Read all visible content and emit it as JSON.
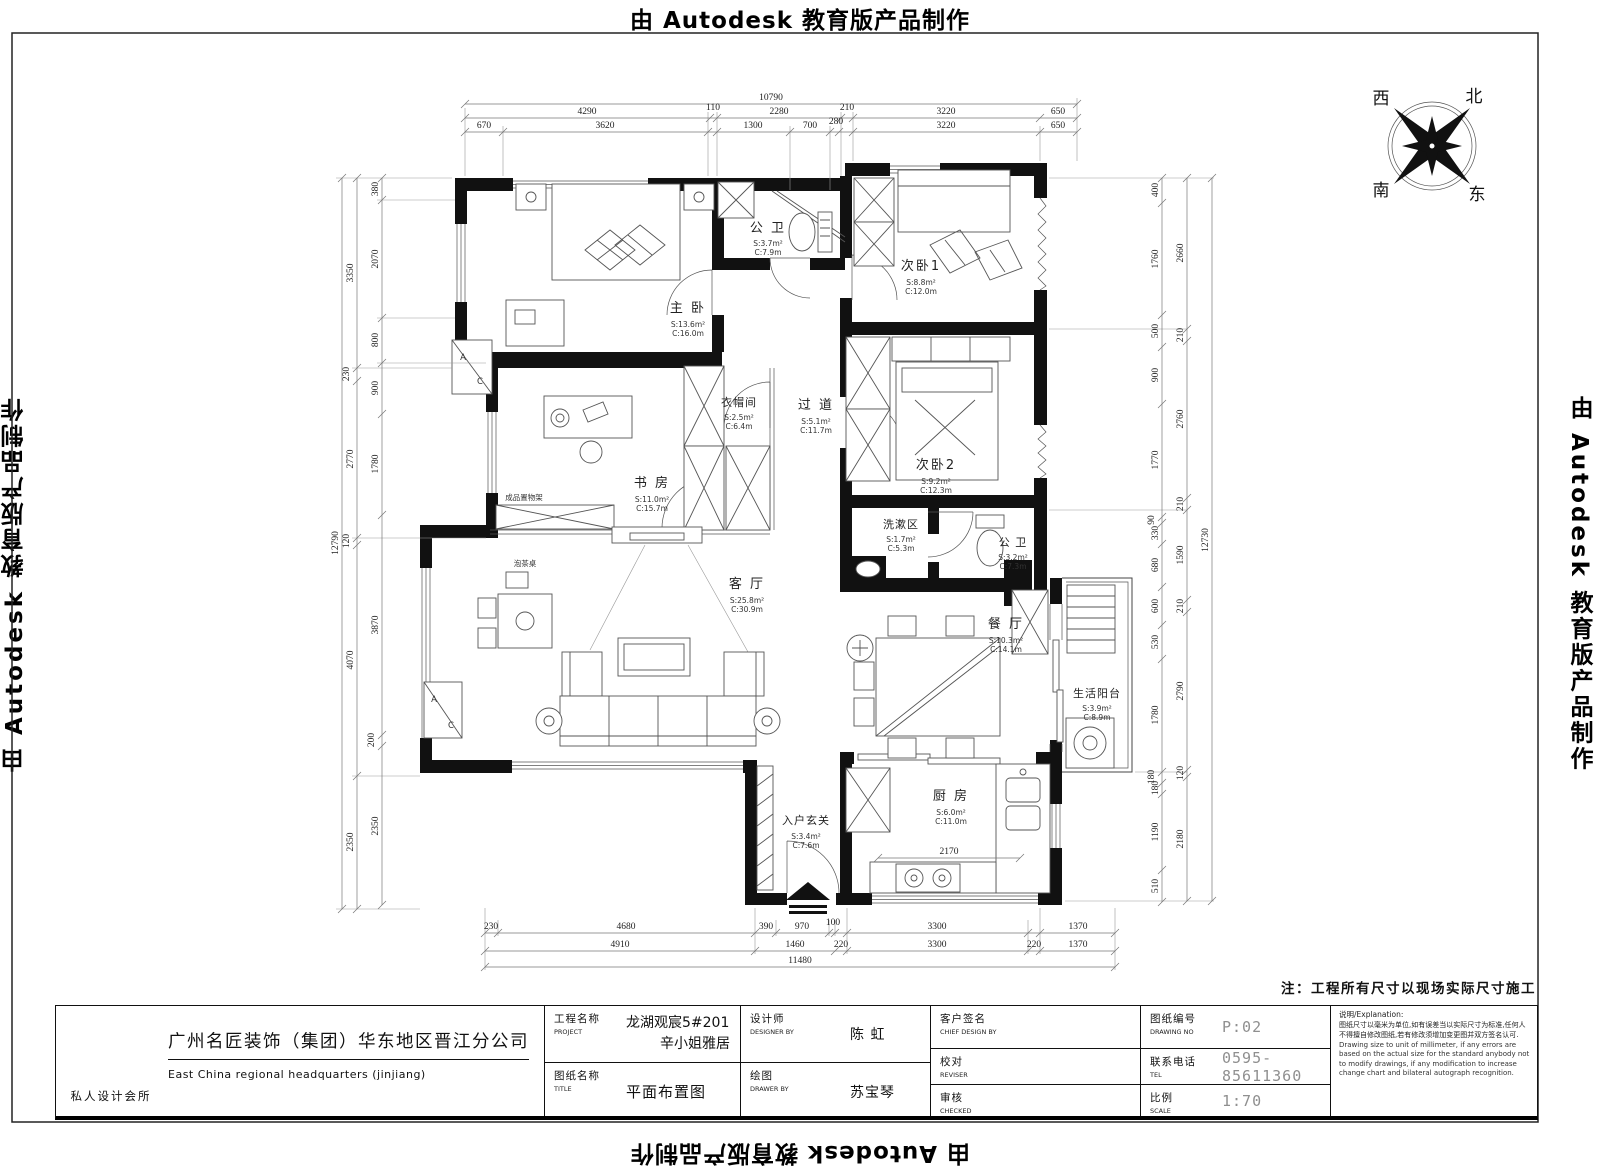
{
  "banner": {
    "by": "由",
    "brand": "Autodesk",
    "product": "教育版产品制作"
  },
  "note": "注：工程所有尺寸以现场实际尺寸施工",
  "compass": {
    "west": "西",
    "north": "北",
    "south": "南",
    "east": "东"
  },
  "rooms": {
    "bath_top": {
      "name": "公 卫",
      "s": "S:3.7m²",
      "c": "C:7.9m"
    },
    "master": {
      "name": "主 卧",
      "s": "S:13.6m²",
      "c": "C:16.0m"
    },
    "bed1": {
      "name": "次卧1",
      "s": "S:8.8m²",
      "c": "C:12.0m"
    },
    "cloak": {
      "name": "衣帽间",
      "s": "S:2.5m²",
      "c": "C:6.4m"
    },
    "hall": {
      "name": "过 道",
      "s": "S:5.1m²",
      "c": "C:11.7m"
    },
    "bed2": {
      "name": "次卧2",
      "s": "S:9.2m²",
      "c": "C:12.3m"
    },
    "study": {
      "name": "书 房",
      "s": "S:11.0m²",
      "c": "C:15.7m"
    },
    "wash": {
      "name": "洗漱区",
      "s": "S:1.7m²",
      "c": "C:5.3m"
    },
    "bath_mid": {
      "name": "公 卫",
      "s": "S:3.2m²",
      "c": "C:7.3m"
    },
    "living": {
      "name": "客 厅",
      "s": "S:25.8m²",
      "c": "C:30.9m"
    },
    "dining": {
      "name": "餐 厅",
      "s": "S:10.3m²",
      "c": "C:14.1m"
    },
    "balcony": {
      "name": "生活阳台",
      "s": "S:3.9m²",
      "c": "C:8.9m"
    },
    "entry": {
      "name": "入户玄关",
      "s": "S:3.4m²",
      "c": "C:7.6m"
    },
    "kitchen": {
      "name": "厨 房",
      "s": "S:6.0m²",
      "c": "C:11.0m"
    }
  },
  "labels": {
    "shelf": "成品置物架",
    "tea": "泡茶桌",
    "ac_a": "A",
    "ac_c": "C"
  },
  "dims": {
    "top_total": [
      "10790"
    ],
    "top_row2": [
      "4290",
      "110",
      "2280",
      "210",
      "3220",
      "650"
    ],
    "top_row3": [
      "670",
      "3620",
      "1300",
      "700",
      "280",
      "3220",
      "650"
    ],
    "left_total": [
      "12790"
    ],
    "left_outer": [
      "3350",
      "230",
      "2770",
      "120",
      "4070",
      "2350"
    ],
    "left_inner": [
      "380",
      "2070",
      "800",
      "900",
      "1780",
      "3870",
      "200",
      "2350"
    ],
    "right_inner": [
      "400",
      "1760",
      "500",
      "900",
      "1770",
      "90",
      "330",
      "680",
      "600",
      "530",
      "1780",
      "180",
      "180",
      "1190",
      "510"
    ],
    "right_mid": [
      "2660",
      "210",
      "2760",
      "210",
      "1590",
      "210",
      "2790",
      "120",
      "2180"
    ],
    "right_total": [
      "12730"
    ],
    "bottom_row1": [
      "230",
      "4680",
      "390",
      "970",
      "100",
      "3300",
      "1370"
    ],
    "bottom_row2": [
      "4910",
      "1460",
      "220",
      "3300",
      "220",
      "1370"
    ],
    "bottom_total": [
      "11480"
    ],
    "kitchen_inner": [
      "2170"
    ]
  },
  "titleblock": {
    "studio": "私人设计会所",
    "company_zh": "广州名匠装饰（集团）华东地区晋江分公司",
    "company_en": "East China regional headquarters (jinjiang)",
    "project_label_zh": "工程名称",
    "project_label_en": "PROJECT",
    "project_line1": "龙湖观宸5#201",
    "project_line2": "辛小姐雅居",
    "drawing_label_zh": "图纸名称",
    "drawing_label_en": "TITLE",
    "drawing_value": "平面布置图",
    "designer_label_zh": "设计师",
    "designer_label_en": "DESIGNER BY",
    "designer_value": "陈 虹",
    "drawer_label_zh": "绘图",
    "drawer_label_en": "DRAWER BY",
    "drawer_value": "苏宝琴",
    "client_label_zh": "客户签名",
    "client_label_en": "CHIEF DESIGN BY",
    "reviser_label_zh": "校对",
    "reviser_label_en": "REVISER",
    "checker_label_zh": "审核",
    "checker_label_en": "CHECKED",
    "no_label_zh": "图纸编号",
    "no_label_en": "DRAWING NO",
    "no_value": "P:02",
    "tel_label_zh": "联系电话",
    "tel_label_en": "TEL",
    "tel_value": "0595-85611360",
    "scale_label_zh": "比例",
    "scale_label_en": "SCALE",
    "scale_value": "1:70",
    "expl_title": "说明/Explanation:",
    "expl_zh": "图纸尺寸以毫米为单位,如有误差当以实际尺寸为标准,任何人不得擅自修改图纸,若有修改须增加变更图并双方签名认可.",
    "expl_en": "Drawing size to unit of millimeter, if any errors are based on the actual size for the standard anybody not to modify drawings, if any modification to increase change chart and bilateral autograph recognition."
  }
}
